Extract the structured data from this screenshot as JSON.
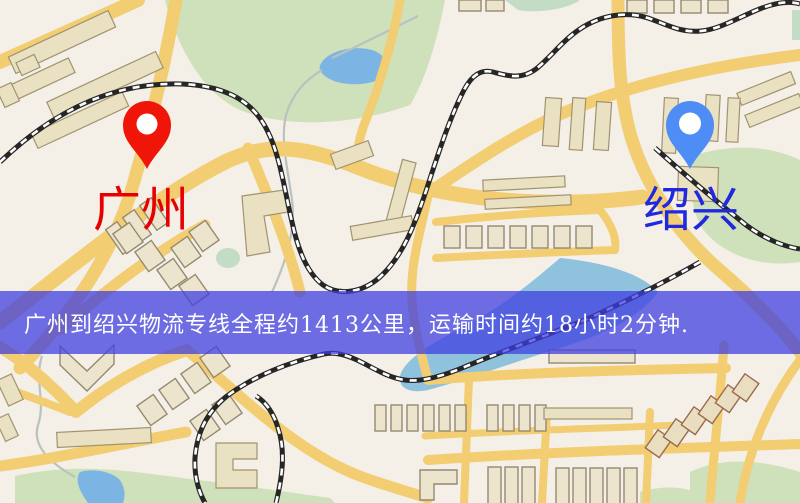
{
  "banner": {
    "text": "广州到绍兴物流专线全程约1413公里，运输时间约18小时2分钟.",
    "text_color": "#ffffff",
    "background": "rgba(62,62,225,0.74)",
    "style_bg": "background-color: rgba(62,62,225,0.74)"
  },
  "markers": {
    "origin": {
      "label": "广州",
      "label_color": "#e60000",
      "pin_color": "#ef1508"
    },
    "destination": {
      "label": "绍兴",
      "label_color": "#2029dd",
      "pin_color": "#4d8df5"
    }
  },
  "map_palette": {
    "land": "#f4efe7",
    "park_green": "#cfe1ba",
    "water_blue": "#7cb5e3",
    "road_yellow": "#f2cd72",
    "building_tan": "#eae0c2",
    "railway_black": "#262626"
  }
}
